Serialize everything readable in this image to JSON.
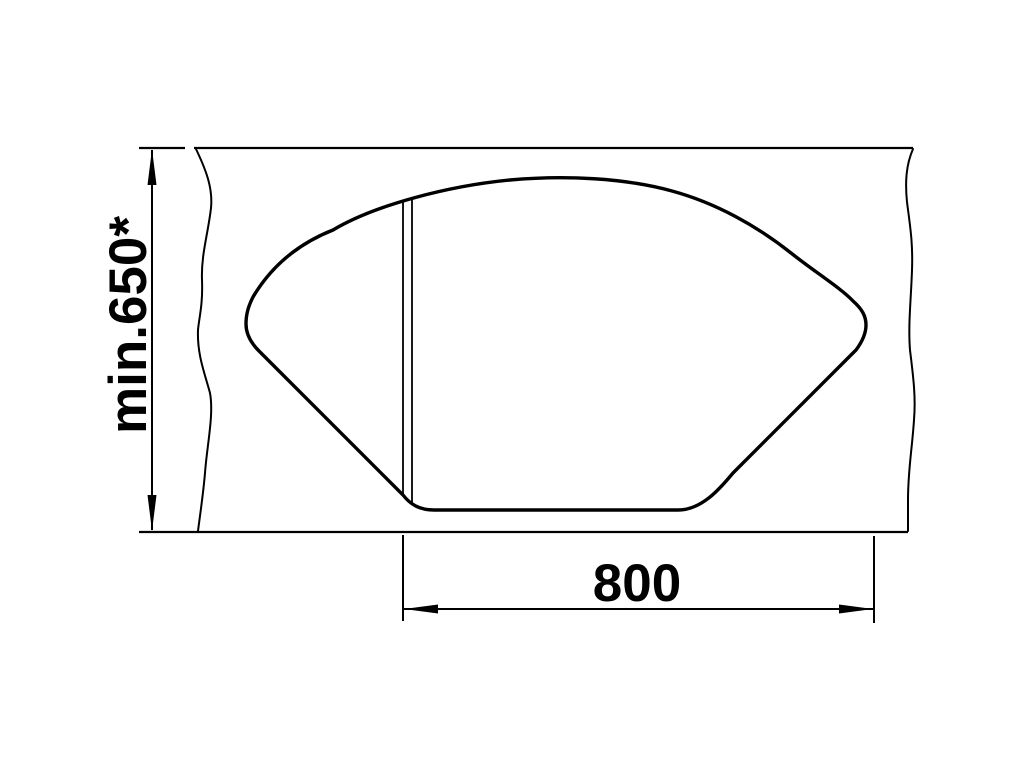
{
  "diagram": {
    "type": "technical-drawing",
    "subject": "Corner sink cutout plan view with installation dimensions",
    "colors": {
      "line": "#000000",
      "background": "#ffffff"
    },
    "dimensions": {
      "depth": {
        "label": "min.650*",
        "value": 650,
        "unit": "mm",
        "qualifier": "min",
        "footnote_marker": "*",
        "orientation": "vertical"
      },
      "width": {
        "label": "800",
        "value": 800,
        "unit": "mm",
        "orientation": "horizontal"
      }
    }
  }
}
